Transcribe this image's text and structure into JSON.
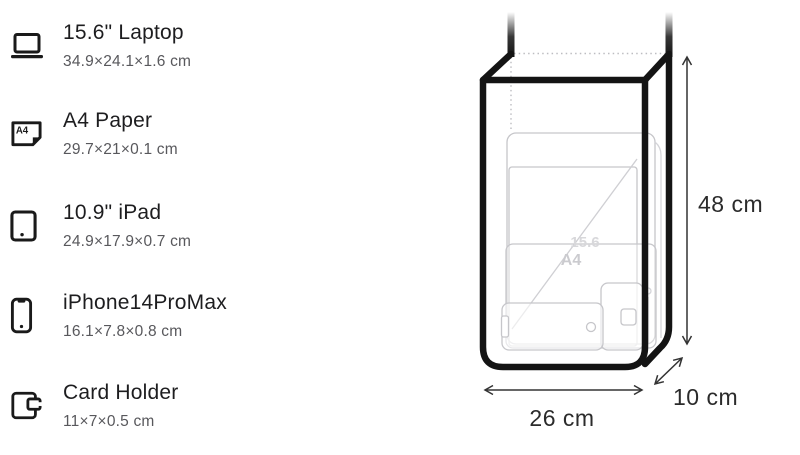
{
  "items": [
    {
      "name": "15.6\" Laptop",
      "dims": "34.9×24.1×1.6 cm",
      "icon": "laptop-icon"
    },
    {
      "name": "A4 Paper",
      "dims": "29.7×21×0.1 cm",
      "icon": "a4-paper-icon"
    },
    {
      "name": "10.9\" iPad",
      "dims": "24.9×17.9×0.7 cm",
      "icon": "ipad-icon"
    },
    {
      "name": "iPhone14ProMax",
      "dims": "16.1×7.8×0.8 cm",
      "icon": "iphone-icon"
    },
    {
      "name": "Card Holder",
      "dims": "11×7×0.5 cm",
      "icon": "card-holder-icon"
    }
  ],
  "icon_text": {
    "a4": "A4"
  },
  "diagram": {
    "height_label": "48 cm",
    "width_label": "26 cm",
    "depth_label": "10 cm",
    "ghost_labels": {
      "laptop": "15.6",
      "a4": "A4"
    },
    "colors": {
      "bag_outline": "#141414",
      "ghost_line": "#c6c6ca",
      "ghost_label": "#d2d2d6",
      "dotted_line": "#bdbdc1",
      "dimension_line": "#333333",
      "dimension_text": "#2b2b2b"
    }
  }
}
